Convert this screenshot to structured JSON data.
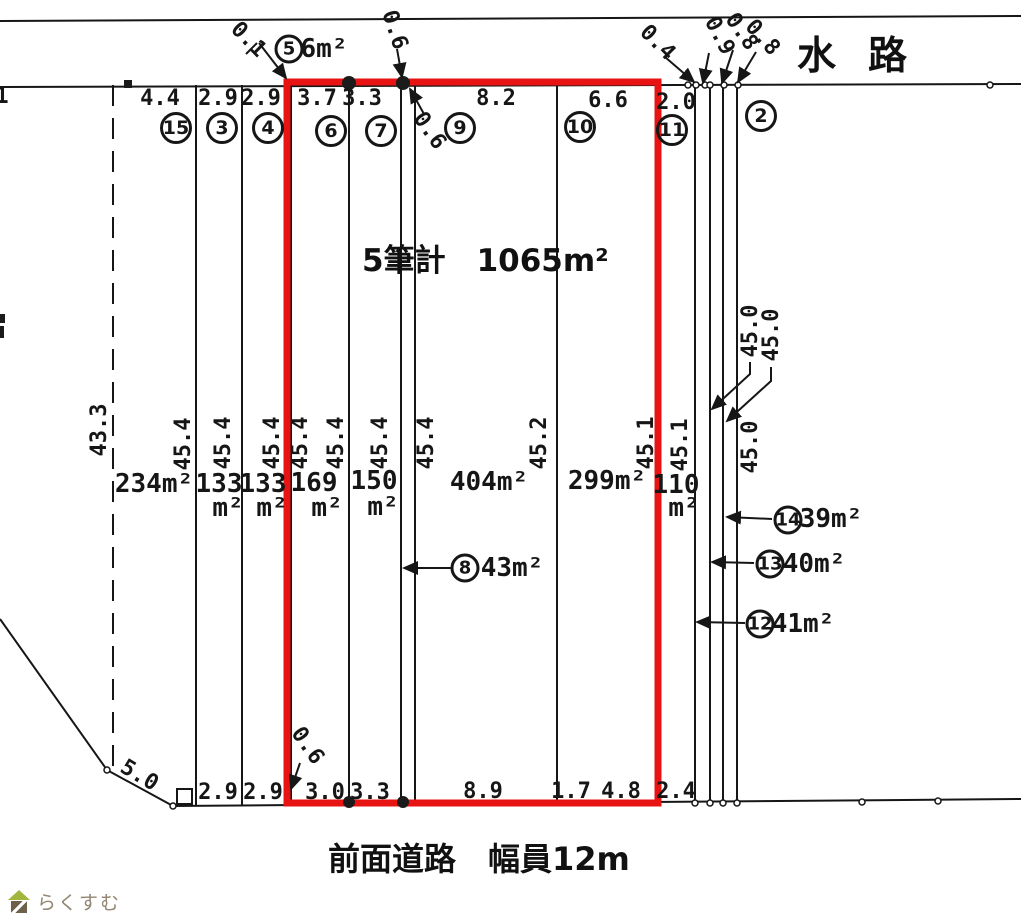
{
  "titles": {
    "waterway": "水路",
    "total_area": "5筆計　1065m²",
    "road": "前面道路　幅員12m"
  },
  "colors": {
    "line": "#161616",
    "highlight_red": "#e81313",
    "watermark_text": "#938672",
    "watermark_roof": "#a2b63c",
    "watermark_body": "#6f604c"
  },
  "watermark": {
    "text": "らくすむ"
  },
  "measurements": {
    "horizontal": [
      {
        "text": "1",
        "x": 2,
        "y": 97
      },
      {
        "text": "4.4",
        "x": 160,
        "y": 99
      },
      {
        "text": "2.9",
        "x": 218,
        "y": 99
      },
      {
        "text": "2.9",
        "x": 261,
        "y": 99
      },
      {
        "text": "3.7",
        "x": 317,
        "y": 99
      },
      {
        "text": "3.3",
        "x": 362,
        "y": 99
      },
      {
        "text": "8.2",
        "x": 496,
        "y": 99
      },
      {
        "text": "6.6",
        "x": 608,
        "y": 101
      },
      {
        "text": "2.0",
        "x": 676,
        "y": 103
      },
      {
        "text": "2.9",
        "x": 218,
        "y": 793
      },
      {
        "text": "2.9",
        "x": 263,
        "y": 793
      },
      {
        "text": "3.0",
        "x": 325,
        "y": 793
      },
      {
        "text": "3.3",
        "x": 370,
        "y": 793
      },
      {
        "text": "8.9",
        "x": 483,
        "y": 792
      },
      {
        "text": "1.7",
        "x": 571,
        "y": 792
      },
      {
        "text": "4.8",
        "x": 621,
        "y": 792
      },
      {
        "text": "2.4",
        "x": 676,
        "y": 792
      }
    ],
    "vertical": [
      {
        "text": "43.3",
        "x": 100,
        "y": 430
      },
      {
        "text": "45.4",
        "x": 184,
        "y": 444
      },
      {
        "text": "45.4",
        "x": 224,
        "y": 443
      },
      {
        "text": "45.4",
        "x": 273,
        "y": 443
      },
      {
        "text": "45.4",
        "x": 301,
        "y": 443
      },
      {
        "text": "45.4",
        "x": 337,
        "y": 443
      },
      {
        "text": "45.4",
        "x": 381,
        "y": 443
      },
      {
        "text": "45.4",
        "x": 427,
        "y": 443
      },
      {
        "text": "45.2",
        "x": 540,
        "y": 443
      },
      {
        "text": "45.1",
        "x": 647,
        "y": 443
      },
      {
        "text": "45.1",
        "x": 681,
        "y": 445
      },
      {
        "text": "45.0",
        "x": 751,
        "y": 331
      },
      {
        "text": "45.0",
        "x": 772,
        "y": 335
      },
      {
        "text": "45.0",
        "x": 751,
        "y": 447
      }
    ],
    "diagonal": [
      {
        "text": "0.1",
        "x": 248,
        "y": 40,
        "rot": 45
      },
      {
        "text": "0.6",
        "x": 394,
        "y": 30,
        "rot": 72
      },
      {
        "text": "0.6",
        "x": 429,
        "y": 131,
        "rot": 55
      },
      {
        "text": "0.4",
        "x": 657,
        "y": 43,
        "rot": 45
      },
      {
        "text": "0.9",
        "x": 719,
        "y": 36,
        "rot": 62
      },
      {
        "text": "0.8",
        "x": 741,
        "y": 32,
        "rot": 55
      },
      {
        "text": "0.8",
        "x": 762,
        "y": 38,
        "rot": 48
      },
      {
        "text": "0.6",
        "x": 307,
        "y": 746,
        "rot": 55
      },
      {
        "text": "5.0",
        "x": 139,
        "y": 776,
        "rot": 31
      }
    ]
  },
  "area_labels": [
    {
      "text": "234m²",
      "x": 154,
      "y": 484
    },
    {
      "text": "133",
      "x": 219,
      "y": 484
    },
    {
      "text": "m²",
      "x": 228,
      "y": 508
    },
    {
      "text": "133",
      "x": 263,
      "y": 484
    },
    {
      "text": "m²",
      "x": 272,
      "y": 508
    },
    {
      "text": "169",
      "x": 314,
      "y": 483
    },
    {
      "text": "m²",
      "x": 327,
      "y": 508
    },
    {
      "text": "150",
      "x": 374,
      "y": 481
    },
    {
      "text": "m²",
      "x": 383,
      "y": 507
    },
    {
      "text": "404m²",
      "x": 489,
      "y": 482
    },
    {
      "text": "299m²",
      "x": 607,
      "y": 481
    },
    {
      "text": "110",
      "x": 676,
      "y": 485
    },
    {
      "text": "m²",
      "x": 684,
      "y": 508
    },
    {
      "text": "6m²",
      "x": 324,
      "y": 49
    },
    {
      "text": "43m²",
      "x": 512,
      "y": 568
    },
    {
      "text": "39m²",
      "x": 831,
      "y": 519
    },
    {
      "text": "40m²",
      "x": 814,
      "y": 564
    },
    {
      "text": "41m²",
      "x": 803,
      "y": 624
    }
  ],
  "parcel_numbers": [
    {
      "num": "15",
      "x": 176,
      "y": 128,
      "small": false
    },
    {
      "num": "3",
      "x": 222,
      "y": 128,
      "small": false
    },
    {
      "num": "4",
      "x": 268,
      "y": 128,
      "small": false
    },
    {
      "num": "6",
      "x": 331,
      "y": 131,
      "small": false
    },
    {
      "num": "7",
      "x": 381,
      "y": 131,
      "small": false
    },
    {
      "num": "9",
      "x": 460,
      "y": 128,
      "small": false
    },
    {
      "num": "10",
      "x": 580,
      "y": 127,
      "small": false
    },
    {
      "num": "11",
      "x": 672,
      "y": 130,
      "small": false
    },
    {
      "num": "2",
      "x": 761,
      "y": 116,
      "small": false
    },
    {
      "num": "5",
      "x": 289,
      "y": 49,
      "small": true
    },
    {
      "num": "8",
      "x": 465,
      "y": 568,
      "small": true
    },
    {
      "num": "14",
      "x": 788,
      "y": 520,
      "small": true
    },
    {
      "num": "13",
      "x": 770,
      "y": 564,
      "small": true
    },
    {
      "num": "12",
      "x": 760,
      "y": 624,
      "small": true
    }
  ]
}
